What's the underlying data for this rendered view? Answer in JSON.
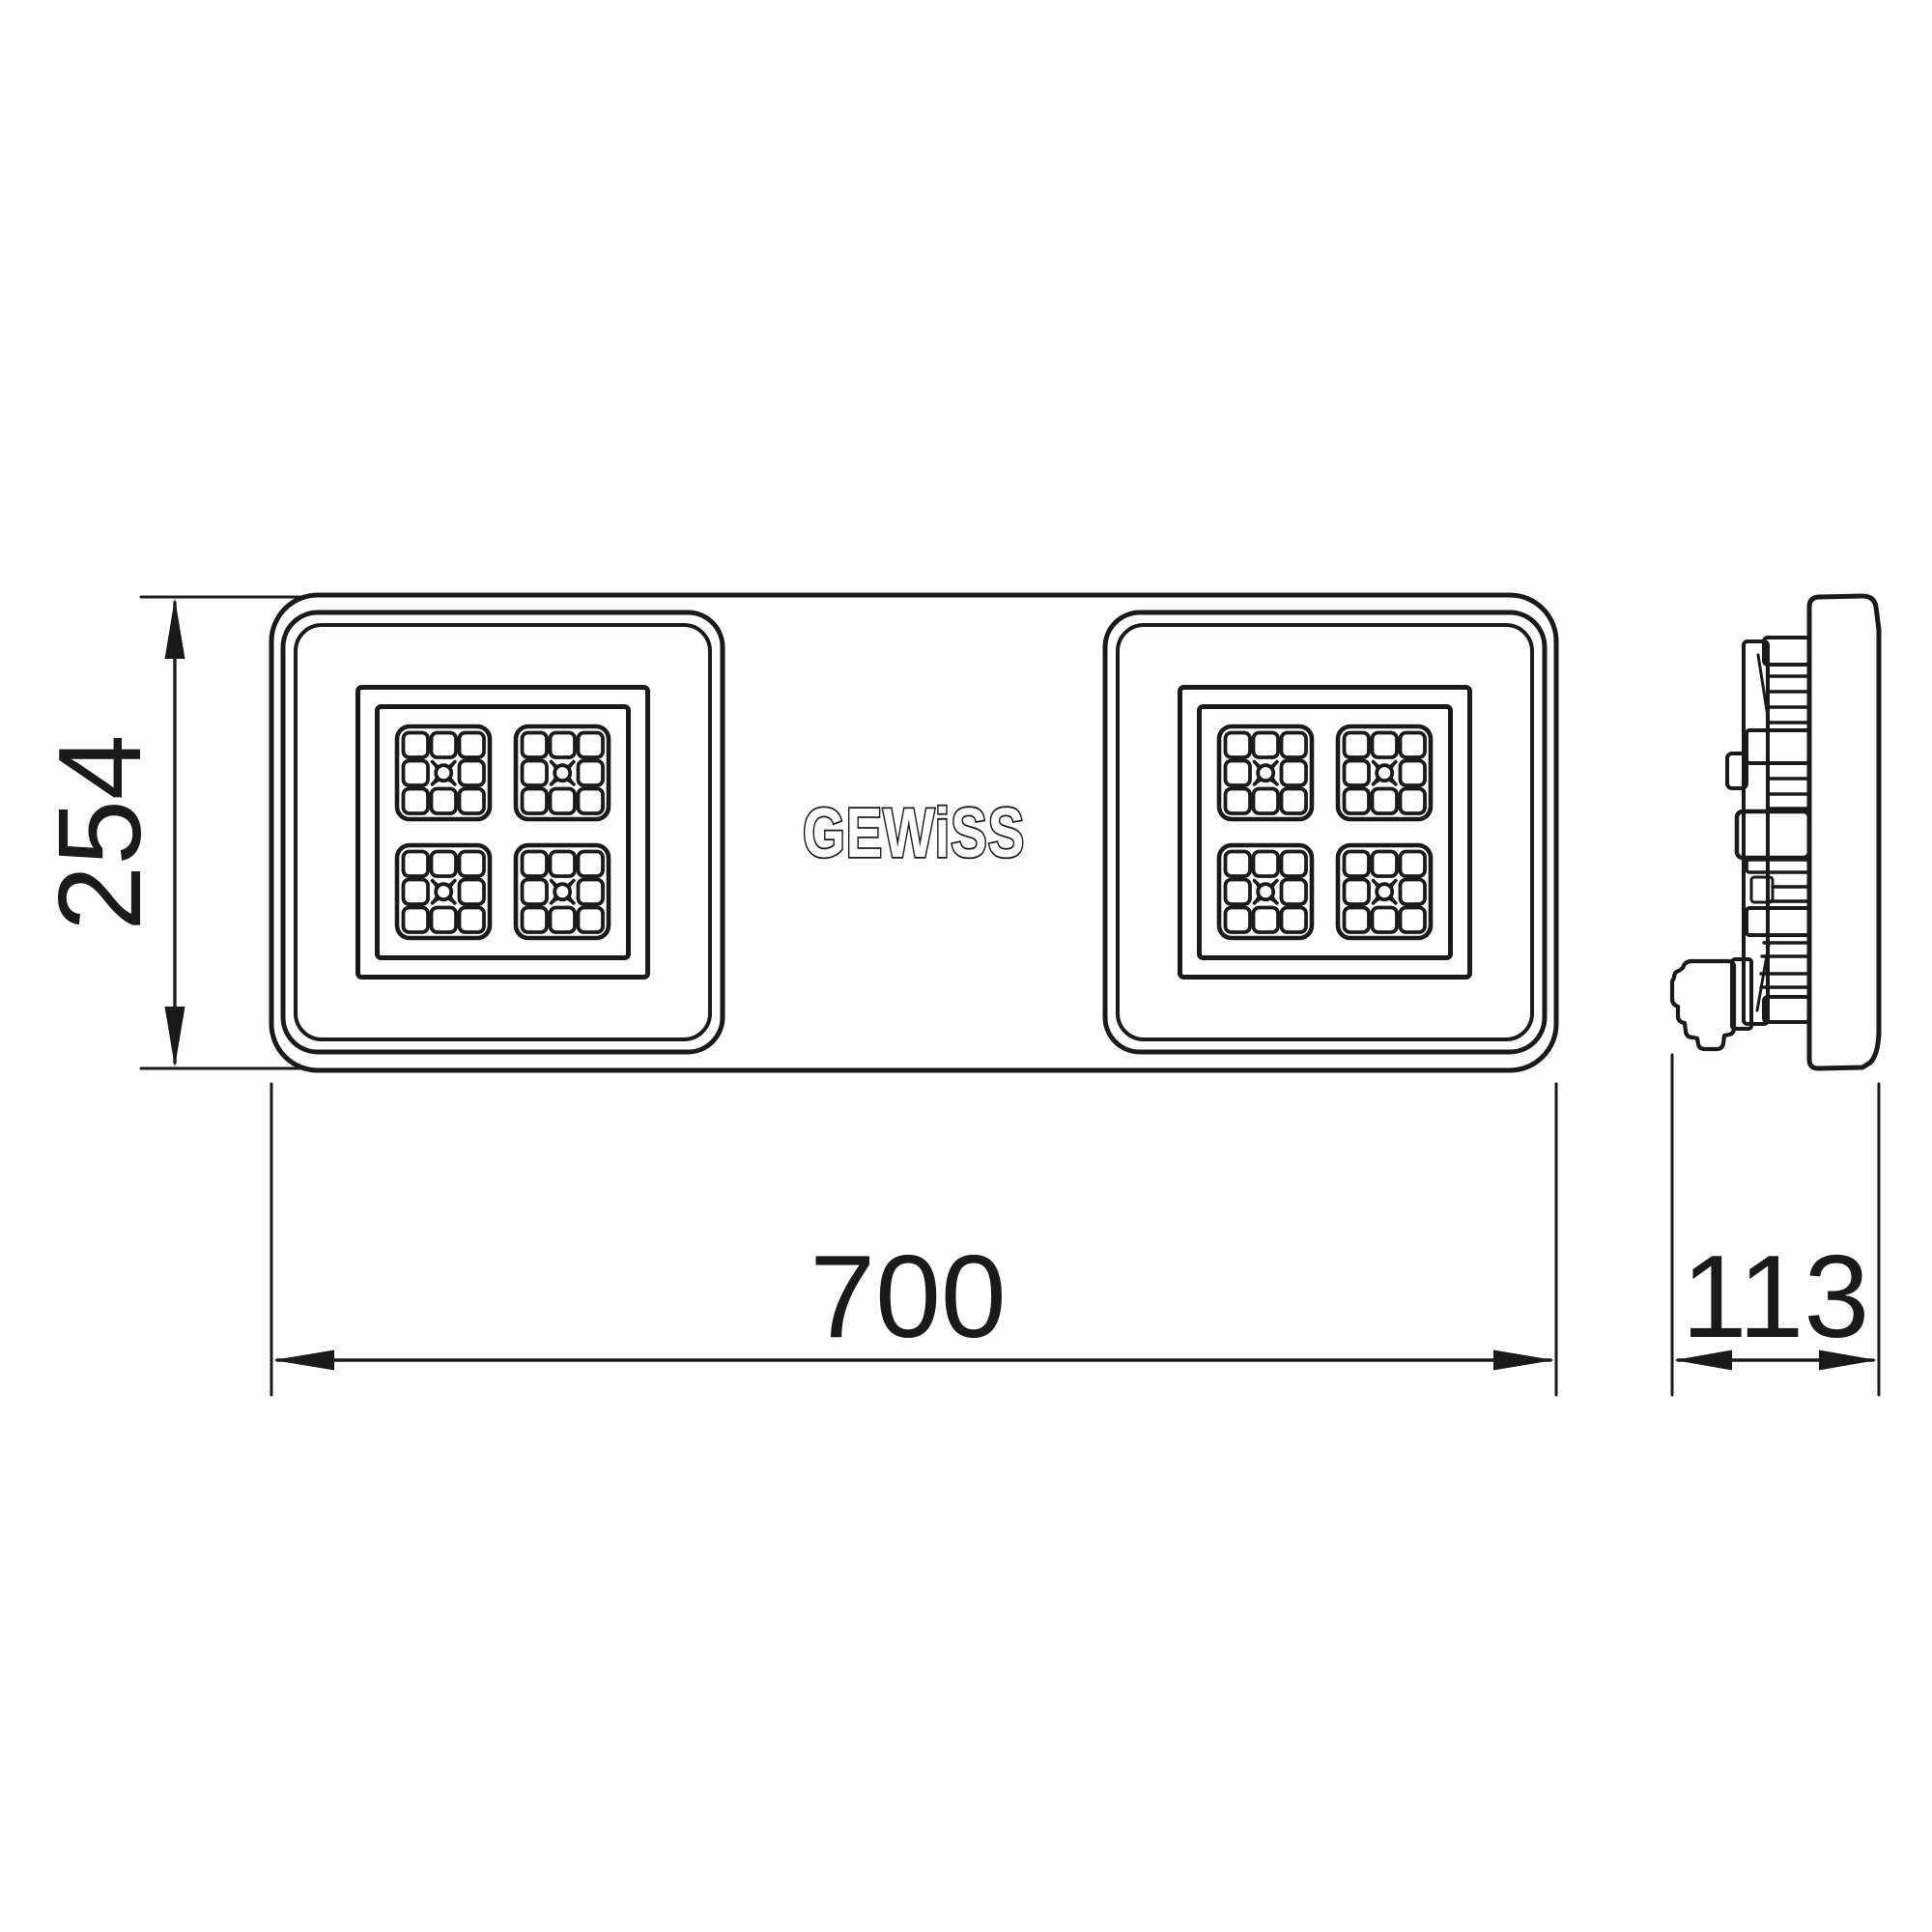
{
  "page": {
    "background": "#ffffff",
    "line_color": "#1a1a1a"
  },
  "brand": {
    "logo_text": "GEWiSS"
  },
  "dimensions": {
    "height_mm": "254",
    "width_mm": "700",
    "depth_mm": "113"
  },
  "drawing": {
    "type": "technical-dimension-drawing",
    "views": [
      "front",
      "side"
    ],
    "led_modules": 2,
    "led_arrays_per_module": 4
  }
}
